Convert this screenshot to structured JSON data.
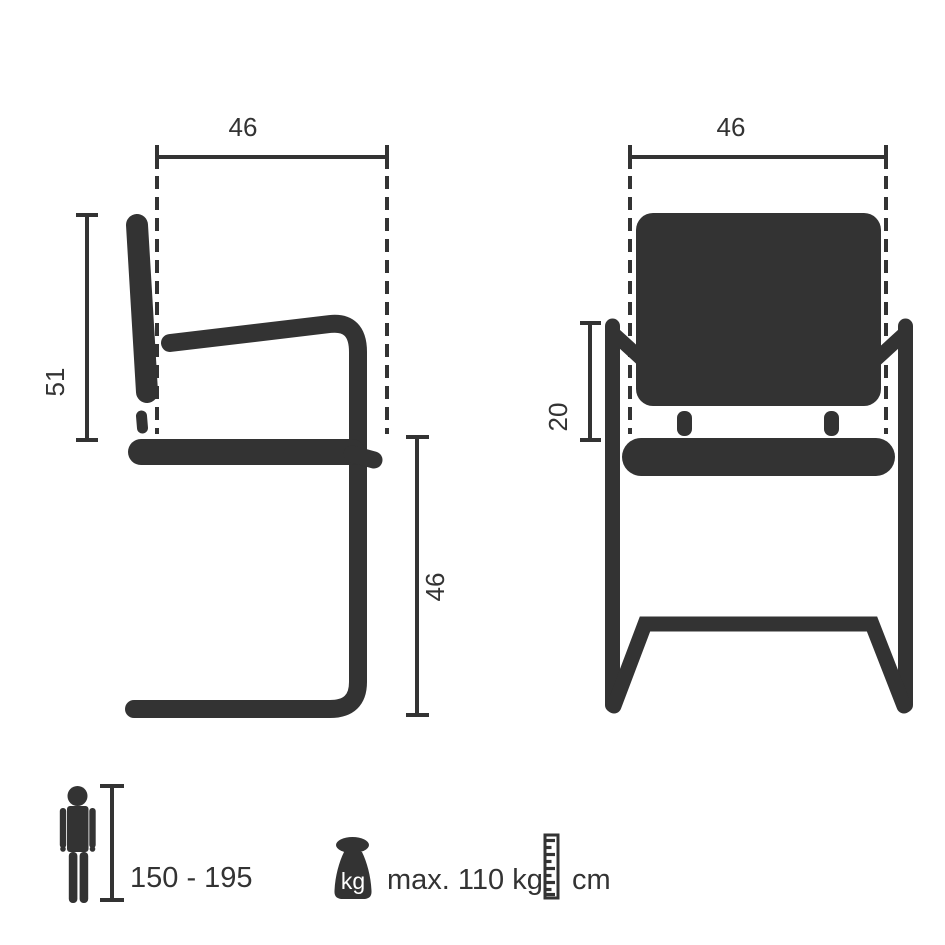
{
  "side_view": {
    "depth_label": "46",
    "back_height_label": "51",
    "seat_height_label": "46"
  },
  "front_view": {
    "width_label": "46",
    "armrest_height_label": "20"
  },
  "legend": {
    "person": {
      "height_range": "150 - 195"
    },
    "weight": {
      "unit": "kg",
      "max_label": "max. 110 kg"
    },
    "ruler": {
      "unit": "cm"
    }
  },
  "colors": {
    "ink": "#333333",
    "background": "#ffffff"
  }
}
